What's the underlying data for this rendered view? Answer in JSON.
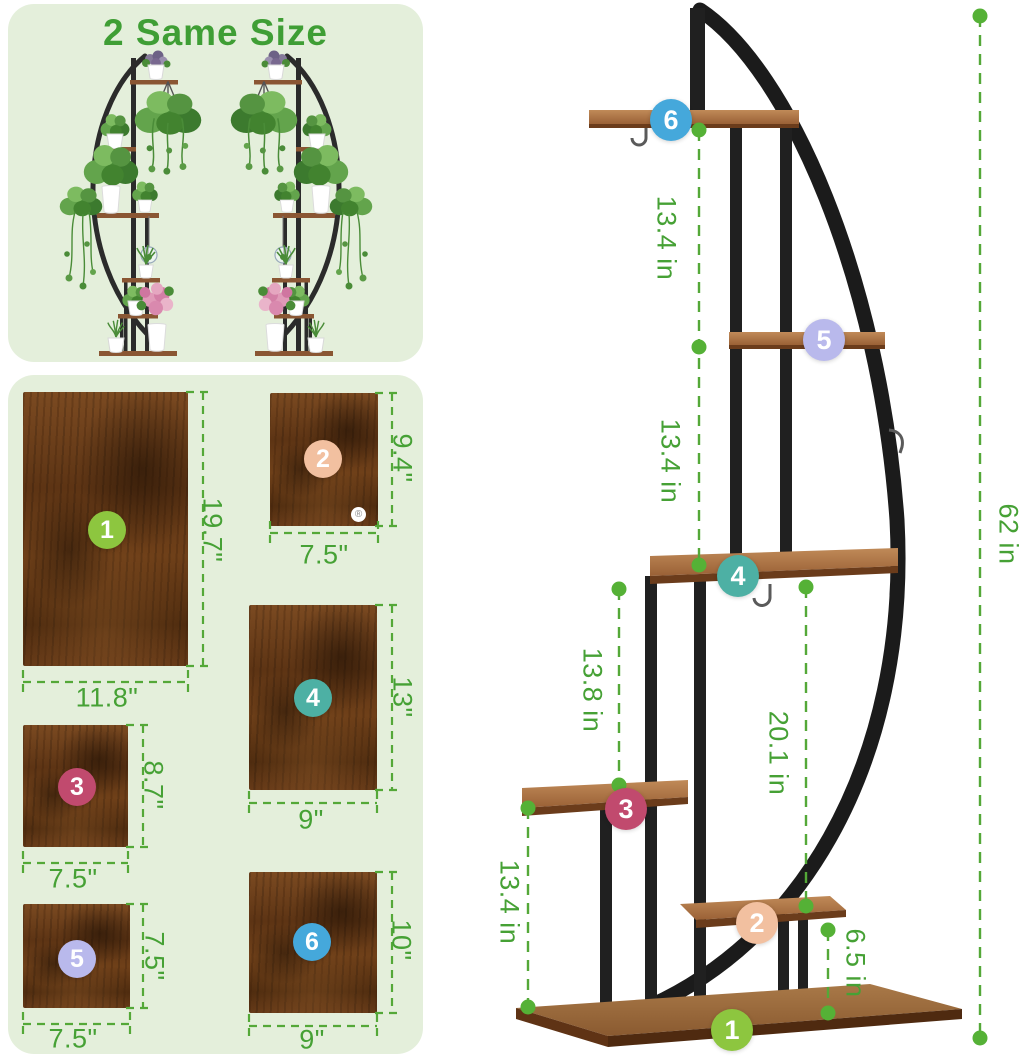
{
  "top_panel": {
    "title": "2 Same Size"
  },
  "tiers": [
    {
      "num": "1",
      "circle_color": "#8dc63f",
      "board_width": "11.8\"",
      "board_height": "19.7\""
    },
    {
      "num": "2",
      "circle_color": "#f2c0a0",
      "board_width": "7.5\"",
      "board_height": "9.4\""
    },
    {
      "num": "3",
      "circle_color": "#c14a6e",
      "board_width": "7.5\"",
      "board_height": "8.7\""
    },
    {
      "num": "4",
      "circle_color": "#4db0a4",
      "board_width": "9\"",
      "board_height": "13\""
    },
    {
      "num": "5",
      "circle_color": "#b9b9ec",
      "board_width": "7.5\"",
      "board_height": "7.5\""
    },
    {
      "num": "6",
      "circle_color": "#45a8db",
      "board_width": "9\"",
      "board_height": "10\""
    }
  ],
  "stand_dims": {
    "tier6_to_5": "13.4 in",
    "tier5_to_4": "13.4 in",
    "tier4_to_3": "13.8 in",
    "tier4_to_2": "20.1 in",
    "tier3_to_base": "13.4 in",
    "tier2_to_base": "6.5 in",
    "total_height": "62 in"
  },
  "board2_mark": "®",
  "colors": {
    "panel_bg": "#e4efdb",
    "title_green": "#3f9e35",
    "dim_text_green": "#46a135",
    "dash_green": "#54a838",
    "frame_black": "#202020",
    "wood_light": "#c08a58",
    "wood_dark": "#5d3414"
  }
}
